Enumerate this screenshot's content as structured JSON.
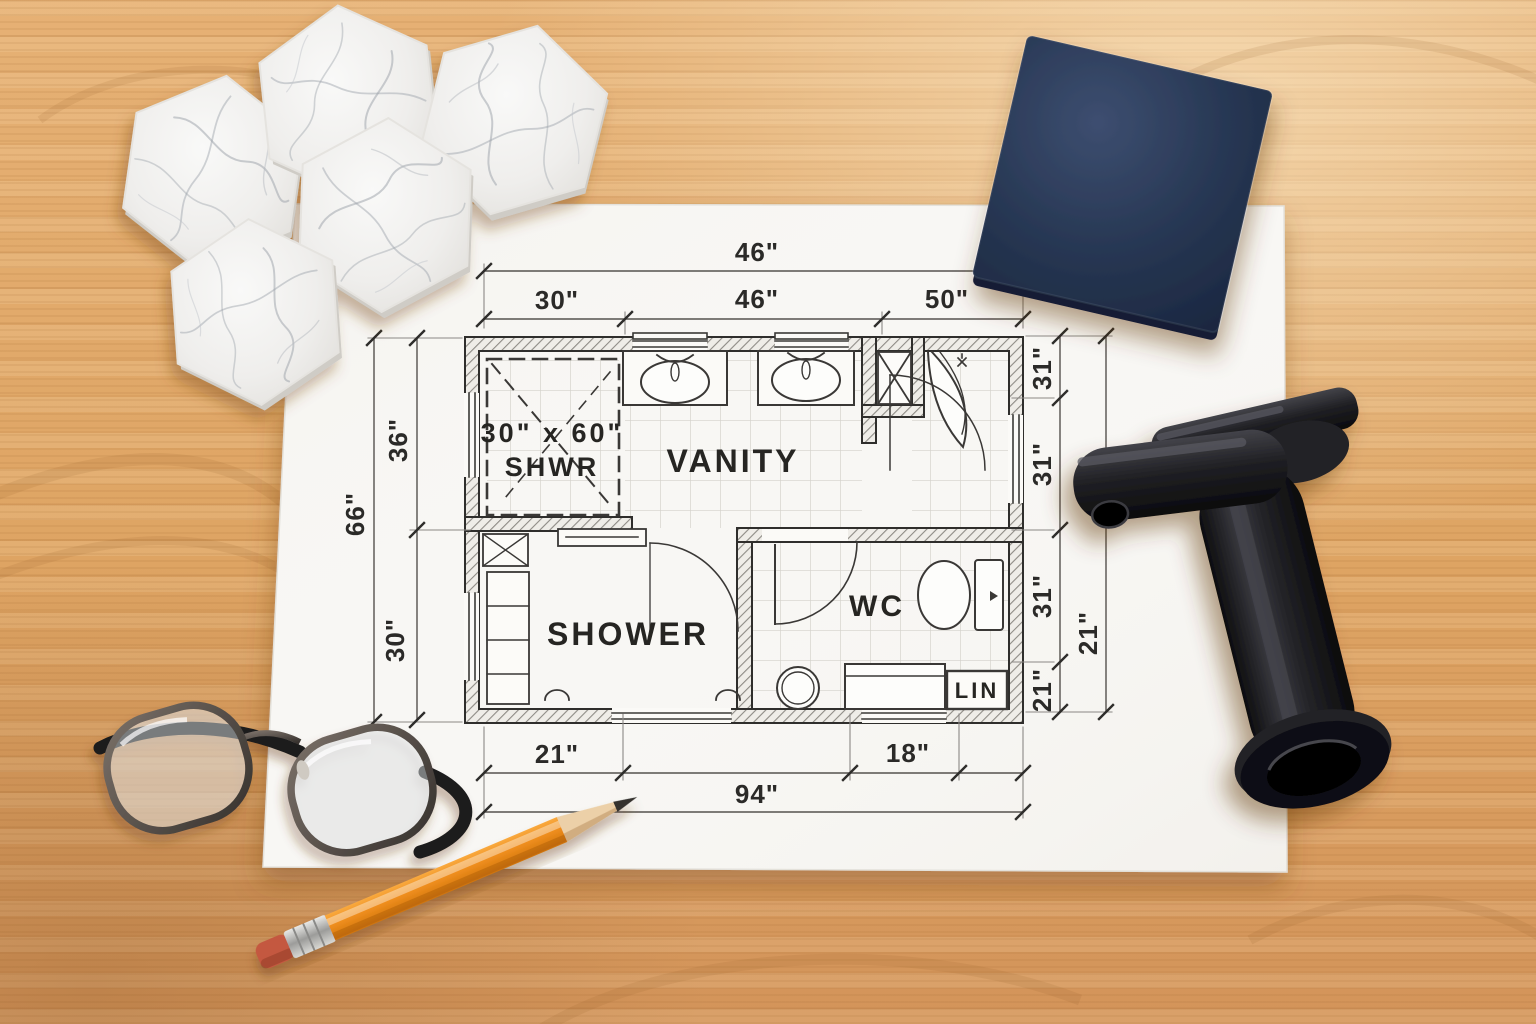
{
  "floor_plan": {
    "rooms": {
      "shwr_line1": "30\" x 60\"",
      "shwr_line2": "SHWR",
      "vanity": "VANITY",
      "shower": "SHOWER",
      "wc": "WC",
      "lin": "LIN"
    },
    "dimensions": {
      "top_total": "46\"",
      "top_segments": [
        "30\"",
        "46\"",
        "50\""
      ],
      "left_total": "66\"",
      "left_segments": [
        "36\"",
        "30\""
      ],
      "right_segments": [
        "31\"",
        "31\"",
        "31\"",
        "21\""
      ],
      "right_total": "21\"",
      "bottom_segments": [
        "21\"",
        "18\""
      ],
      "bottom_total": "94\""
    }
  },
  "colors": {
    "wood": "#dfa66a",
    "paper": "#f8f7f4",
    "plan_ink": "#2e2d2b",
    "navy_sample": "#26344f",
    "marble_tile": "#f0efec",
    "faucet_black": "#17171a",
    "pencil_orange": "#ef8f1f",
    "eraser_red": "#c4593f"
  }
}
